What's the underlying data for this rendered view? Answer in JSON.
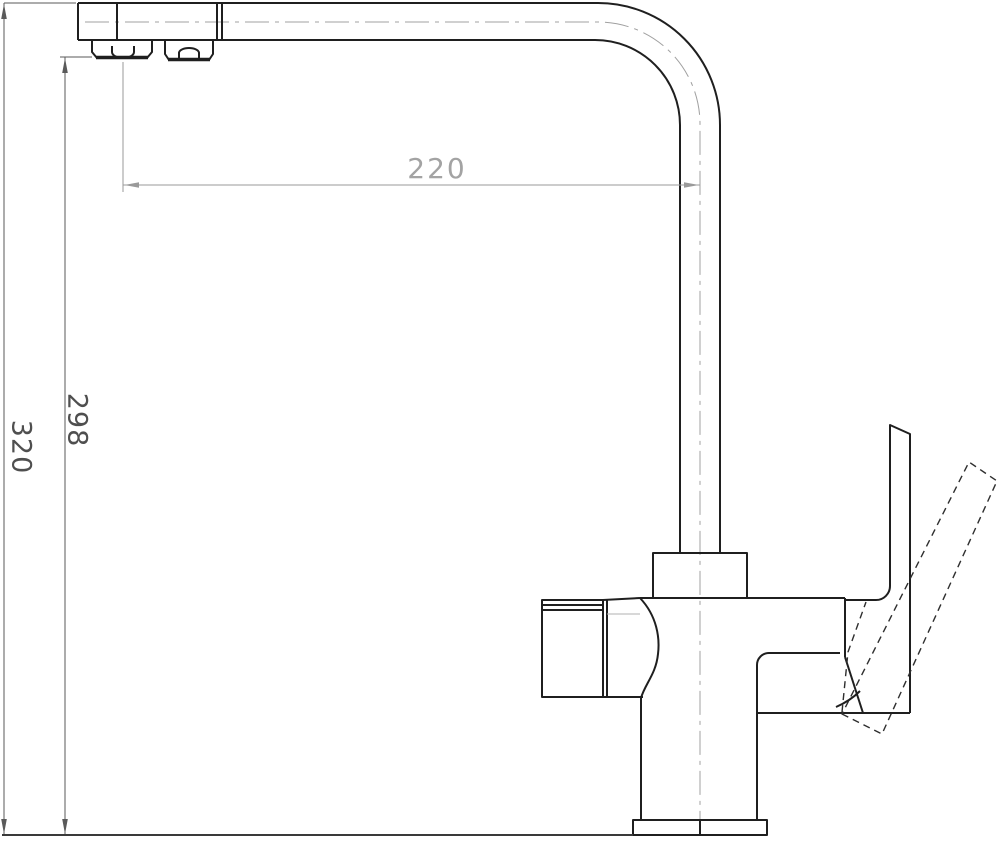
{
  "drawing": {
    "kind": "technical-line-drawing",
    "subject": "kitchen-faucet-side-elevation",
    "dimensions": {
      "spout_reach": {
        "label": "220",
        "orientation": "horizontal"
      },
      "outlet_height": {
        "label": "298",
        "orientation": "vertical"
      },
      "overall_height": {
        "label": "320",
        "orientation": "vertical"
      }
    },
    "colors": {
      "background": "#ffffff",
      "outline": "#1f1f1f",
      "dimension_vertical": "#5a5a5a",
      "dimension_horizontal": "#9a9a9a",
      "dimension_text_horizontal": "#a3a3a3",
      "dimension_text_vertical": "#4f4f4f",
      "centerline": "#a0a0a0",
      "hidden_line": "#2e2e2e"
    }
  }
}
